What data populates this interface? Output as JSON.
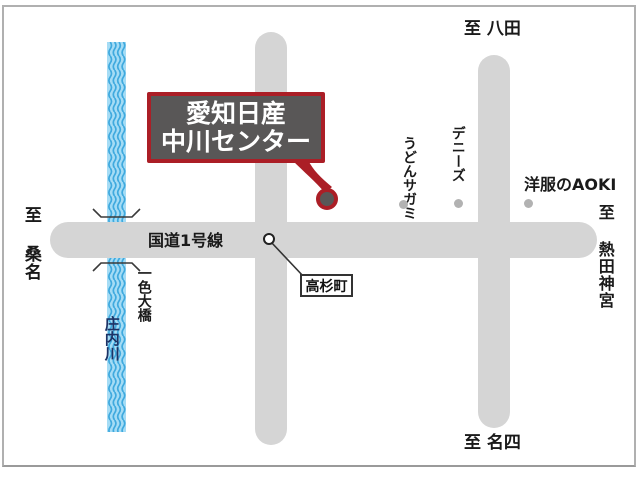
{
  "map": {
    "callout": {
      "line1": "愛知日産",
      "line2": "中川センター"
    },
    "roads": {
      "route1_label": "国道1号線"
    },
    "destinations": {
      "top": "至 八田",
      "bottom": "至 名四",
      "left": "至 桑名",
      "right": "至 熱田神宮"
    },
    "pois": [
      {
        "label": "うどんサガミ"
      },
      {
        "label": "デニーズ"
      },
      {
        "label": "洋服のAOKI"
      }
    ],
    "river": {
      "name": "庄内川",
      "bridge_label": "一色大橋"
    },
    "intersection": {
      "label": "高杉町"
    },
    "colors": {
      "road_gray": "#d5d5d5",
      "river_blue": "#a5dcf5",
      "river_wave_blue": "#3fa9de",
      "accent_red": "#ab1e26",
      "callout_bg": "#595757",
      "poi_dot_gray": "#b2b2b2",
      "river_text_navy": "#1d3366"
    }
  }
}
